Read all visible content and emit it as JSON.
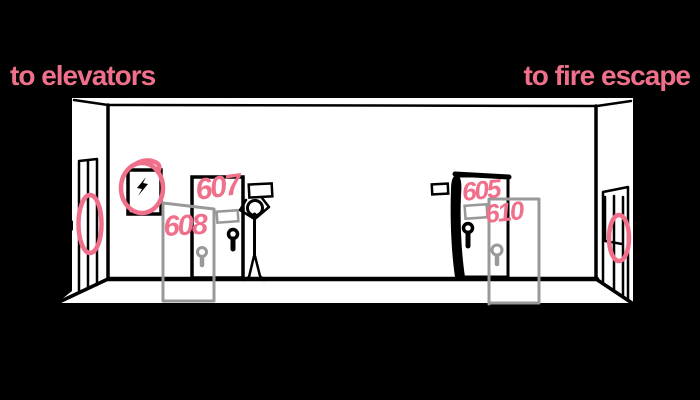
{
  "scene": {
    "background": "#000000",
    "ink": "#000000",
    "paper": "#ffffff",
    "accent_pink": "#F0708C",
    "ghost_gray": "#999999"
  },
  "signs": {
    "left": "to elevators",
    "right": "to fire escape"
  },
  "rooms": {
    "door_607": "607",
    "door_608": "608",
    "door_605": "605",
    "door_610": "610"
  }
}
